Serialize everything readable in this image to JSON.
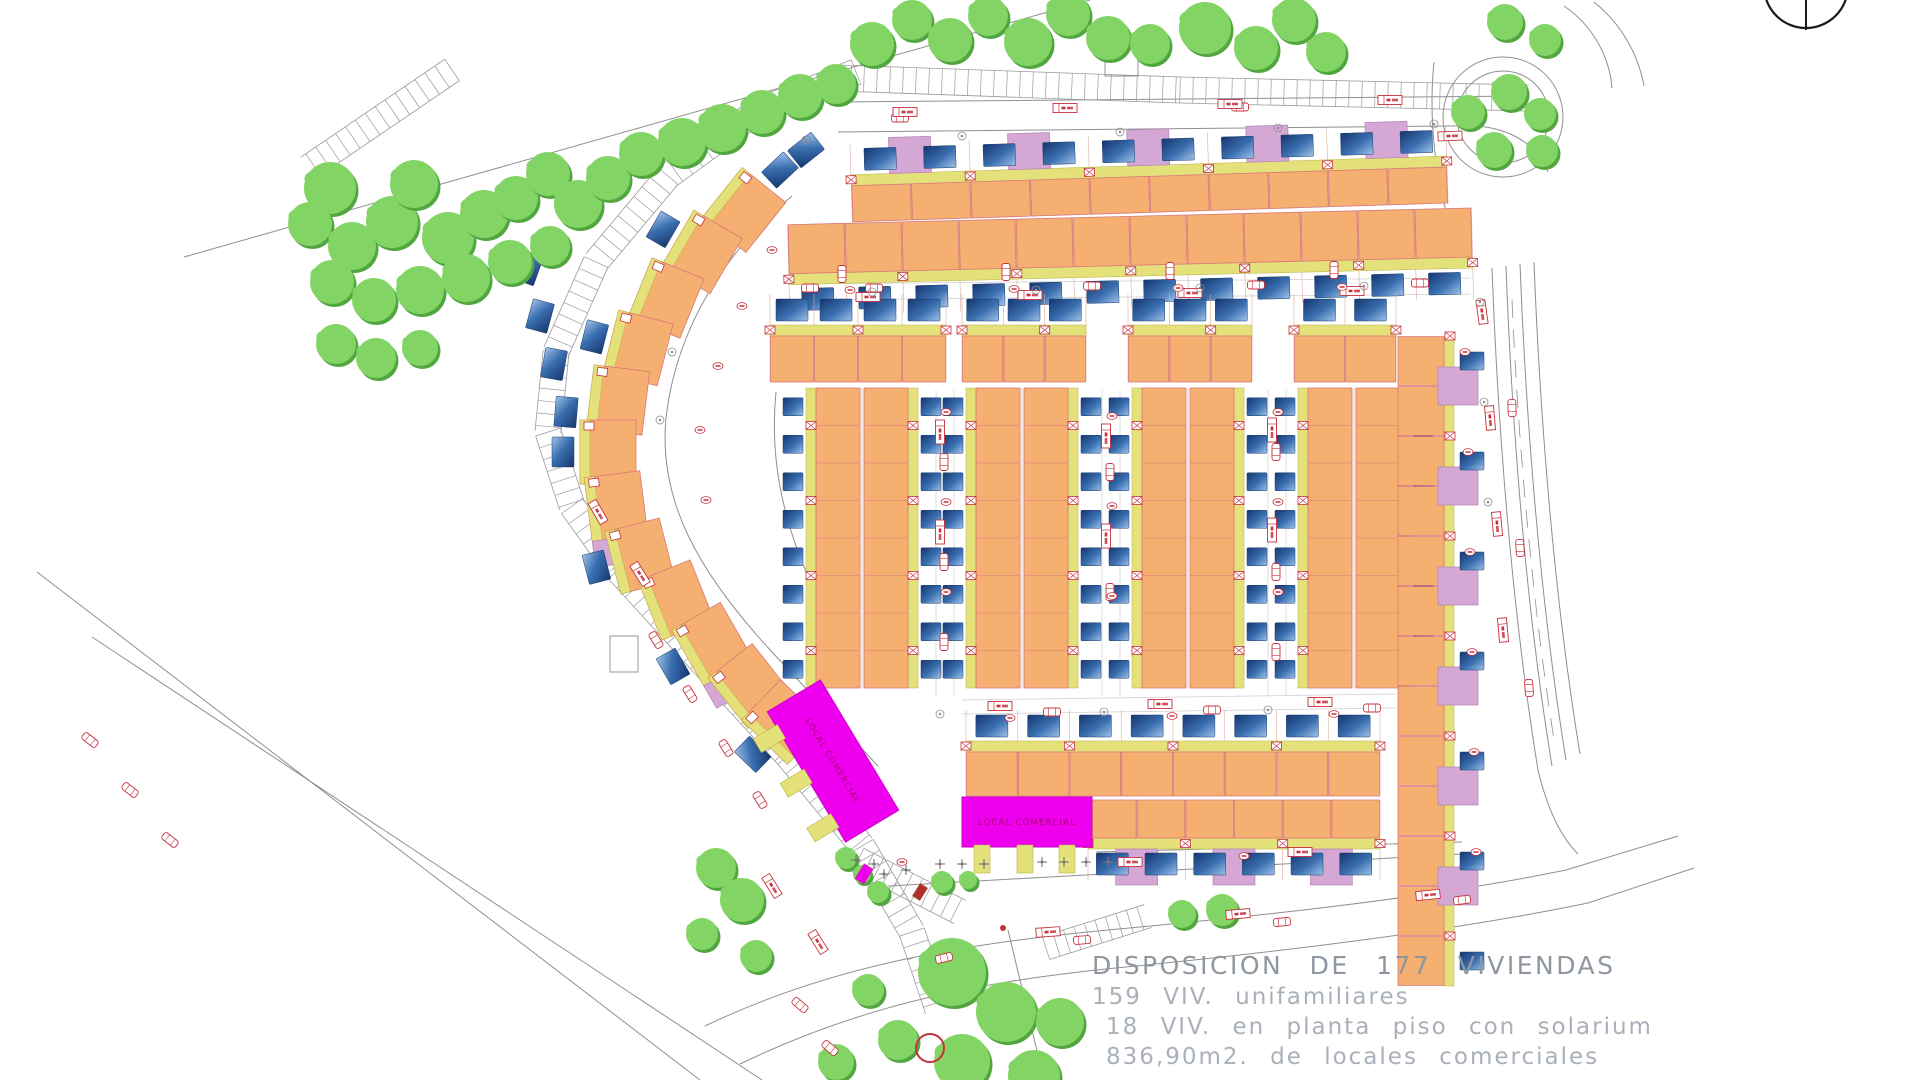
{
  "texts": {
    "title": "DISPOSICION DE 177 VIVIENDAS",
    "line2": "159 VIV. unifamiliares",
    "line3": "18 VIV. en planta piso con solarium",
    "line4": "836,90m2. de locales comerciales",
    "local": "LOCAL COMERCIAL"
  },
  "plan": {
    "colors": {
      "orange": "#f4af71",
      "orangeStroke": "#d9787a",
      "yellow": "#e4e07a",
      "yellowStroke": "#b9b345",
      "plum": "#d4a7d4",
      "plumStroke": "#b684b6",
      "poolDark": "#16366e",
      "poolMid": "#3a6fb0",
      "poolLight": "#9fc2e8",
      "magenta": "#ee00ee",
      "magentaStroke": "#cc00cc",
      "magentaText": "#a8006e",
      "treeMain": "#82d465",
      "treeShadow": "#51a63f",
      "road": "#8f8f8f",
      "ladder": "#9a9a9a",
      "red": "#c8303c",
      "lot": "#d8ab9e",
      "gray": "#8a8a8a",
      "light": "#cfcfcf",
      "compass": "#1a1a1a"
    },
    "arcCenter": [
      1046,
      452
    ],
    "rows": [
      {
        "x": 852,
        "y": 167,
        "w": 596,
        "units": 10,
        "h": 36,
        "strip": "top",
        "plums": true,
        "tilt": [
          -1.8,
          1448,
          200
        ]
      },
      {
        "x": 788,
        "y": 208,
        "w": 684,
        "units": 12,
        "h": 49,
        "strip": "bottom",
        "plums": false,
        "tilt": [
          -1.4,
          1472,
          235
        ]
      },
      {
        "x": 770,
        "y": 336,
        "w": 176,
        "units": 4,
        "h": 46,
        "strip": "top",
        "plums": false
      },
      {
        "x": 962,
        "y": 336,
        "w": 124,
        "units": 3,
        "h": 46,
        "strip": "top",
        "plums": false
      },
      {
        "x": 1128,
        "y": 336,
        "w": 124,
        "units": 3,
        "h": 46,
        "strip": "top",
        "plums": false
      },
      {
        "x": 1294,
        "y": 336,
        "w": 102,
        "units": 2,
        "h": 46,
        "strip": "top",
        "plums": false
      },
      {
        "x": 966,
        "y": 752,
        "w": 414,
        "units": 8,
        "h": 44,
        "strip": "top",
        "plums": false
      },
      {
        "x": 1088,
        "y": 800,
        "w": 292,
        "units": 6,
        "h": 38,
        "strip": "bottom",
        "plums": true
      }
    ],
    "vgroups": [
      {
        "x": 806,
        "y": 388,
        "h": 300,
        "units": 8,
        "barW": 54,
        "gap": 4
      },
      {
        "x": 966,
        "y": 388,
        "h": 300,
        "units": 8,
        "barW": 54,
        "gap": 4
      },
      {
        "x": 1132,
        "y": 388,
        "h": 300,
        "units": 8,
        "barW": 54,
        "gap": 4
      },
      {
        "x": 1298,
        "y": 388,
        "h": 300,
        "units": 8,
        "barW": 54,
        "gap": 4
      }
    ],
    "rightCol": {
      "x": 1398,
      "y": 336,
      "units": 13,
      "uh": 50,
      "w": 46
    },
    "arcHouses": [
      [
        744,
        210
      ],
      [
        702,
        252
      ],
      [
        666,
        298
      ],
      [
        638,
        348
      ],
      [
        618,
        400
      ],
      [
        608,
        452
      ],
      [
        616,
        506
      ],
      [
        640,
        556
      ],
      [
        676,
        600
      ],
      [
        712,
        644
      ],
      [
        750,
        686
      ],
      [
        784,
        722
      ]
    ],
    "wingPools": [
      [
        528,
        268
      ],
      [
        540,
        316
      ],
      [
        554,
        364
      ],
      [
        566,
        412
      ],
      [
        806,
        150
      ],
      [
        780,
        170
      ]
    ],
    "magenta": [
      {
        "cx": 833,
        "cy": 761,
        "w": 152,
        "h": 62,
        "rot": 59,
        "tabs": [
          -52,
          0,
          52
        ]
      },
      {
        "cx": 1027,
        "cy": 822,
        "w": 130,
        "h": 50,
        "rot": 0,
        "tabs": [
          -45,
          -2,
          40
        ]
      }
    ],
    "ladders": [
      {
        "pts": [
          [
            838,
            78
          ],
          [
            1180,
            90
          ],
          [
            1528,
            98
          ]
        ],
        "w": 26,
        "s": 13
      },
      {
        "pts": [
          [
            856,
            72
          ],
          [
            756,
            112
          ],
          [
            668,
            176
          ],
          [
            596,
            262
          ],
          [
            556,
            352
          ],
          [
            548,
            432
          ],
          [
            572,
            506
          ],
          [
            618,
            570
          ],
          [
            700,
            660
          ],
          [
            788,
            756
          ],
          [
            862,
            846
          ],
          [
            912,
            932
          ],
          [
            938,
            1010
          ]
        ],
        "w": 26,
        "s": 12.5
      },
      {
        "pts": [
          [
            858,
            860
          ],
          [
            960,
            912
          ]
        ],
        "w": 26,
        "s": 11
      },
      {
        "pts": [
          [
            1046,
            948
          ],
          [
            1148,
            916
          ]
        ],
        "w": 24,
        "s": 11
      },
      {
        "pts": [
          [
            452,
            70
          ],
          [
            308,
            168
          ]
        ],
        "w": 26,
        "s": 12
      }
    ],
    "roads": [
      "M184 257 L1090 0",
      "M37 572 L700 1080",
      "M92 637 L762 1080",
      "M705 1026 C830 966 960 944 1108 930 C1260 916 1430 898 1566 870 L1678 836",
      "M740 1064 C868 1002 988 980 1136 966 C1295 950 1458 930 1588 903 L1694 868",
      "M838 102 L1528 96",
      "M838 132 L1452 126",
      "M1452 126 C1504 122 1536 142 1548 172",
      "M1492 268 C1498 430 1512 610 1538 770 C1548 812 1562 838 1578 854",
      "M1506 266 C1512 428 1526 608 1552 766",
      "M1520 264 C1526 420 1540 600 1566 760",
      "M1534 262 C1540 418 1554 596 1580 754",
      "M1564 6 A110 110 0 0 1 1612 88",
      "M1594 2 A140 140 0 0 1 1644 86",
      "M1434 62 C1428 122 1436 182 1452 232",
      "M792 196 C724 252 676 330 666 418 C658 502 700 574 772 652 L878 766",
      "M1096 852 L1462 842",
      "M888 886 C1050 876 1250 866 1462 854",
      "M1008 930 L1044 1080",
      "M776 392 C768 470 788 552 842 642"
    ],
    "dashed": [
      "M1512 300 C1518 440 1532 600 1554 740"
    ],
    "lightLines": [
      [
        936,
        390,
        936,
        696
      ],
      [
        954,
        390,
        954,
        696
      ],
      [
        1102,
        390,
        1102,
        696
      ],
      [
        1120,
        390,
        1120,
        696
      ],
      [
        1268,
        390,
        1268,
        696
      ],
      [
        1286,
        390,
        1286,
        696
      ],
      [
        790,
        284,
        1470,
        278
      ],
      [
        790,
        300,
        1470,
        294
      ],
      [
        962,
        700,
        1396,
        694
      ],
      [
        962,
        714,
        1396,
        708
      ]
    ],
    "roundabout": {
      "cx": 1503,
      "cy": 117,
      "r1": 60,
      "r2": 46
    },
    "compass": {
      "cx": 1806,
      "cy": -14,
      "r": 42,
      "lines": [
        [
          1806,
          -58,
          1806,
          30
        ],
        [
          1742,
          -2,
          1870,
          -2
        ]
      ]
    },
    "rectOutlines": [
      [
        1105,
        48,
        33,
        28
      ],
      [
        610,
        636,
        28,
        36
      ]
    ],
    "smallRects": [
      {
        "x": 864,
        "y": 874,
        "w": 11,
        "h": 18,
        "rot": 32,
        "fill": "#ee00ee"
      },
      {
        "x": 920,
        "y": 892,
        "w": 9,
        "h": 15,
        "rot": 32,
        "fill": "#b03030"
      }
    ],
    "redCircle": [
      930,
      1048,
      14
    ],
    "redDot": [
      1003,
      928,
      3
    ],
    "trees": [
      [
        330,
        188,
        26
      ],
      [
        310,
        224,
        22
      ],
      [
        352,
        246,
        24
      ],
      [
        392,
        222,
        26
      ],
      [
        414,
        184,
        24
      ],
      [
        448,
        238,
        26
      ],
      [
        484,
        214,
        24
      ],
      [
        516,
        198,
        22
      ],
      [
        548,
        174,
        22
      ],
      [
        578,
        204,
        24
      ],
      [
        608,
        178,
        22
      ],
      [
        641,
        154,
        22
      ],
      [
        682,
        142,
        24
      ],
      [
        722,
        128,
        24
      ],
      [
        762,
        112,
        22
      ],
      [
        800,
        96,
        22
      ],
      [
        836,
        84,
        20
      ],
      [
        332,
        282,
        22
      ],
      [
        374,
        300,
        22
      ],
      [
        420,
        290,
        24
      ],
      [
        466,
        278,
        24
      ],
      [
        510,
        262,
        22
      ],
      [
        550,
        246,
        20
      ],
      [
        336,
        344,
        20
      ],
      [
        376,
        358,
        20
      ],
      [
        420,
        348,
        18
      ],
      [
        872,
        44,
        22
      ],
      [
        912,
        20,
        20
      ],
      [
        950,
        40,
        22
      ],
      [
        988,
        16,
        20
      ],
      [
        1028,
        42,
        24
      ],
      [
        1068,
        14,
        22
      ],
      [
        1108,
        38,
        22
      ],
      [
        1150,
        44,
        20
      ],
      [
        1205,
        28,
        26
      ],
      [
        1256,
        48,
        22
      ],
      [
        1294,
        20,
        22
      ],
      [
        1326,
        52,
        20
      ],
      [
        1505,
        22,
        18
      ],
      [
        1545,
        40,
        16
      ],
      [
        1509,
        92,
        18
      ],
      [
        1468,
        112,
        17
      ],
      [
        1540,
        114,
        16
      ],
      [
        1494,
        150,
        18
      ],
      [
        1542,
        151,
        16
      ],
      [
        952,
        972,
        34
      ],
      [
        1006,
        1012,
        30
      ],
      [
        962,
        1062,
        28
      ],
      [
        1034,
        1076,
        26
      ],
      [
        898,
        1040,
        20
      ],
      [
        868,
        990,
        16
      ],
      [
        836,
        1062,
        18
      ],
      [
        1060,
        1022,
        24
      ],
      [
        716,
        868,
        20
      ],
      [
        742,
        900,
        22
      ],
      [
        702,
        934,
        16
      ],
      [
        756,
        956,
        16
      ],
      [
        846,
        858,
        11
      ],
      [
        862,
        874,
        9
      ],
      [
        878,
        892,
        11
      ],
      [
        942,
        882,
        11
      ],
      [
        968,
        880,
        9
      ],
      [
        1182,
        914,
        14
      ],
      [
        1222,
        910,
        16
      ]
    ],
    "cars": [
      [
        810,
        288,
        0
      ],
      [
        874,
        288,
        0
      ],
      [
        1092,
        286,
        0
      ],
      [
        1256,
        285,
        0
      ],
      [
        1420,
        283,
        0
      ],
      [
        842,
        274,
        90
      ],
      [
        1006,
        272,
        90
      ],
      [
        1170,
        271,
        90
      ],
      [
        1334,
        270,
        90
      ],
      [
        944,
        462,
        90
      ],
      [
        944,
        562,
        90
      ],
      [
        944,
        642,
        90
      ],
      [
        1110,
        472,
        90
      ],
      [
        1110,
        592,
        90
      ],
      [
        1276,
        452,
        90
      ],
      [
        1276,
        572,
        90
      ],
      [
        1276,
        652,
        90
      ],
      [
        1052,
        712,
        0
      ],
      [
        1212,
        710,
        0
      ],
      [
        1372,
        708,
        0
      ],
      [
        1082,
        940,
        -4
      ],
      [
        1282,
        922,
        -5
      ],
      [
        1462,
        900,
        -7
      ],
      [
        944,
        958,
        -14
      ],
      [
        656,
        640,
        58
      ],
      [
        690,
        694,
        58
      ],
      [
        726,
        748,
        58
      ],
      [
        760,
        800,
        58
      ],
      [
        1512,
        408,
        88
      ],
      [
        1520,
        548,
        87
      ],
      [
        1529,
        688,
        86
      ],
      [
        900,
        118,
        0
      ],
      [
        1240,
        107,
        0
      ],
      [
        90,
        740,
        38
      ],
      [
        130,
        790,
        38
      ],
      [
        170,
        840,
        38
      ],
      [
        800,
        1005,
        40
      ],
      [
        830,
        1048,
        40
      ]
    ],
    "pills": [
      [
        868,
        297,
        0
      ],
      [
        1030,
        295,
        0
      ],
      [
        1190,
        293,
        0
      ],
      [
        1352,
        291,
        0
      ],
      [
        905,
        112,
        0
      ],
      [
        1065,
        108,
        0
      ],
      [
        1230,
        104,
        0
      ],
      [
        1390,
        100,
        0
      ],
      [
        940,
        432,
        90
      ],
      [
        940,
        532,
        90
      ],
      [
        1106,
        436,
        90
      ],
      [
        1106,
        536,
        90
      ],
      [
        1272,
        430,
        90
      ],
      [
        1272,
        530,
        90
      ],
      [
        1000,
        706,
        0
      ],
      [
        1160,
        704,
        0
      ],
      [
        1320,
        702,
        0
      ],
      [
        1048,
        932,
        -4
      ],
      [
        1238,
        914,
        -5
      ],
      [
        1428,
        895,
        -6
      ],
      [
        598,
        512,
        60
      ],
      [
        640,
        574,
        58
      ],
      [
        772,
        886,
        58
      ],
      [
        818,
        942,
        58
      ],
      [
        1482,
        312,
        82
      ],
      [
        1490,
        418,
        85
      ],
      [
        1497,
        524,
        85
      ],
      [
        1503,
        630,
        85
      ],
      [
        1130,
        862,
        0
      ],
      [
        1300,
        852,
        0
      ],
      [
        1450,
        136,
        -2
      ]
    ],
    "ovals": [
      [
        850,
        290
      ],
      [
        1014,
        289
      ],
      [
        1178,
        288
      ],
      [
        1342,
        287
      ],
      [
        946,
        412
      ],
      [
        946,
        502
      ],
      [
        946,
        592
      ],
      [
        1112,
        416
      ],
      [
        1112,
        506
      ],
      [
        1112,
        596
      ],
      [
        1278,
        412
      ],
      [
        1278,
        502
      ],
      [
        1278,
        592
      ],
      [
        1465,
        352
      ],
      [
        1468,
        452
      ],
      [
        1470,
        552
      ],
      [
        1472,
        652
      ],
      [
        1474,
        752
      ],
      [
        1476,
        852
      ],
      [
        1010,
        718
      ],
      [
        1172,
        716
      ],
      [
        1334,
        714
      ],
      [
        902,
        862
      ],
      [
        1244,
        856
      ],
      [
        772,
        250
      ],
      [
        742,
        306
      ],
      [
        718,
        366
      ],
      [
        700,
        430
      ],
      [
        706,
        500
      ]
    ],
    "gcircs": [
      [
        806,
        140
      ],
      [
        962,
        136
      ],
      [
        1120,
        132
      ],
      [
        1278,
        128
      ],
      [
        1434,
        124
      ],
      [
        872,
        292
      ],
      [
        1036,
        290
      ],
      [
        1200,
        288
      ],
      [
        1364,
        286
      ],
      [
        940,
        714
      ],
      [
        1104,
        712
      ],
      [
        1268,
        710
      ],
      [
        1480,
        302
      ],
      [
        1484,
        402
      ],
      [
        1488,
        502
      ],
      [
        672,
        352
      ],
      [
        660,
        420
      ]
    ],
    "crosses": [
      [
        940,
        864
      ],
      [
        962,
        864
      ],
      [
        984,
        864
      ],
      [
        1042,
        862
      ],
      [
        1064,
        862
      ],
      [
        1086,
        862
      ],
      [
        1108,
        862
      ],
      [
        906,
        870
      ],
      [
        884,
        874
      ],
      [
        856,
        860
      ],
      [
        874,
        864
      ]
    ]
  }
}
